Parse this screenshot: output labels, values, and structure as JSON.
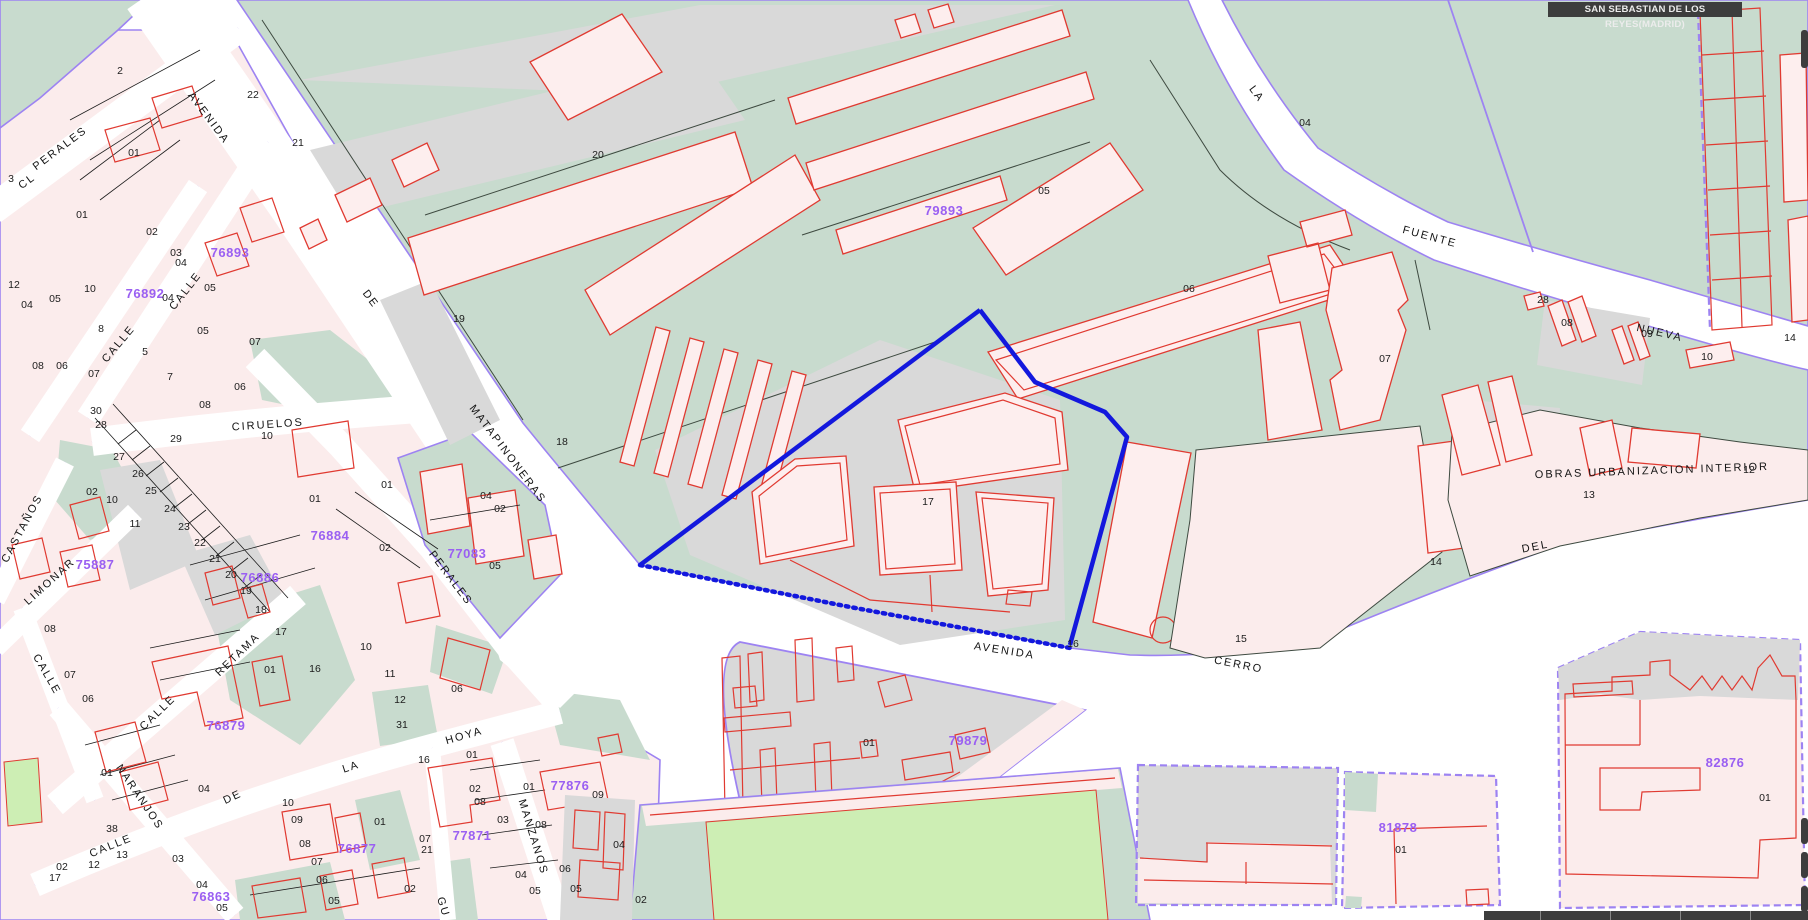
{
  "title_bar": {
    "text": "SAN SEBASTIAN DE LOS REYES(MADRID)"
  },
  "colors": {
    "block_teal": "#c8dbce",
    "road_gray": "#d9d9d9",
    "parcel_pink": "#fbecec",
    "building_red": "#e03a31",
    "boundary_purple": "#9d83f2",
    "highlight_blue": "#1318dd",
    "code_purple": "#9a5ff2",
    "field_green": "#cdeeb4",
    "titlebar_bg": "#3d3d3d",
    "street_white": "#ffffff"
  },
  "map": {
    "street_labels": [
      {
        "text": "AVENIDA",
        "x": 206,
        "y": 120,
        "rot": 53,
        "size": 12
      },
      {
        "text": "DE",
        "x": 368,
        "y": 301,
        "rot": 53
      },
      {
        "text": "MATAPINONERAS",
        "x": 505,
        "y": 456,
        "rot": 53
      },
      {
        "text": "CL",
        "x": 29,
        "y": 184,
        "rot": -37,
        "size": 10.5
      },
      {
        "text": "PERALES",
        "x": 62,
        "y": 151,
        "rot": -37,
        "size": 10.5
      },
      {
        "text": "CALLE",
        "x": 188,
        "y": 293,
        "rot": -52,
        "size": 10.5
      },
      {
        "text": "CALLE",
        "x": 121,
        "y": 346,
        "rot": -50,
        "size": 10.5
      },
      {
        "text": "CIRUELOS",
        "x": 268,
        "y": 428,
        "rot": -4,
        "size": 11.5
      },
      {
        "text": "CASTAÑOS",
        "x": 25,
        "y": 530,
        "rot": -62,
        "size": 10.5
      },
      {
        "text": "LIMONAR",
        "x": 52,
        "y": 584,
        "rot": -42,
        "size": 10.5
      },
      {
        "text": "CALLE",
        "x": 44,
        "y": 676,
        "rot": 60,
        "size": 10.5
      },
      {
        "text": "RETAMA",
        "x": 240,
        "y": 657,
        "rot": -44,
        "size": 10.5
      },
      {
        "text": "CALLE",
        "x": 160,
        "y": 715,
        "rot": -44,
        "size": 10.5
      },
      {
        "text": "NARANJOS",
        "x": 137,
        "y": 799,
        "rot": 56,
        "size": 10.5
      },
      {
        "text": "CALLE",
        "x": 112,
        "y": 849,
        "rot": -22,
        "size": 10.5
      },
      {
        "text": "DE",
        "x": 234,
        "y": 800,
        "rot": -25,
        "size": 10.5
      },
      {
        "text": "LA",
        "x": 352,
        "y": 770,
        "rot": -18,
        "size": 10.5
      },
      {
        "text": "HOYA",
        "x": 465,
        "y": 739,
        "rot": -16,
        "size": 10.5
      },
      {
        "text": "MANZANOS",
        "x": 530,
        "y": 838,
        "rot": 73,
        "size": 10.5
      },
      {
        "text": "PERALES",
        "x": 448,
        "y": 580,
        "rot": 53,
        "size": 10.5
      },
      {
        "text": "GU",
        "x": 440,
        "y": 908,
        "rot": 73,
        "size": 10.5
      },
      {
        "text": "AVENIDA",
        "x": 1004,
        "y": 654,
        "rot": 9
      },
      {
        "text": "CERRO",
        "x": 1238,
        "y": 668,
        "rot": 11
      },
      {
        "text": "DEL",
        "x": 1536,
        "y": 550,
        "rot": -11
      },
      {
        "text": "FUENTE",
        "x": 1429,
        "y": 240,
        "rot": 15
      },
      {
        "text": "NUEVA",
        "x": 1659,
        "y": 336,
        "rot": 13
      },
      {
        "text": "LA",
        "x": 1254,
        "y": 96,
        "rot": 53
      },
      {
        "text": "OBRAS URBANIZACION INTERIOR",
        "x": 1652,
        "y": 474,
        "rot": -2,
        "size": 9.5
      }
    ],
    "block_codes": [
      {
        "text": "76893",
        "x": 230,
        "y": 257
      },
      {
        "text": "76892",
        "x": 145,
        "y": 298
      },
      {
        "text": "76884",
        "x": 330,
        "y": 540
      },
      {
        "text": "75887",
        "x": 95,
        "y": 569
      },
      {
        "text": "76886",
        "x": 260,
        "y": 582
      },
      {
        "text": "77083",
        "x": 467,
        "y": 558
      },
      {
        "text": "76879",
        "x": 226,
        "y": 730
      },
      {
        "text": "77876",
        "x": 570,
        "y": 790
      },
      {
        "text": "77871",
        "x": 472,
        "y": 840
      },
      {
        "text": "76877",
        "x": 357,
        "y": 853
      },
      {
        "text": "76863",
        "x": 211,
        "y": 901
      },
      {
        "text": "79893",
        "x": 944,
        "y": 215
      },
      {
        "text": "79879",
        "x": 968,
        "y": 745
      },
      {
        "text": "82876",
        "x": 1725,
        "y": 767
      },
      {
        "text": "81878",
        "x": 1398,
        "y": 832
      }
    ],
    "parcel_numbers": [
      {
        "text": "2",
        "x": 120,
        "y": 74
      },
      {
        "text": "01",
        "x": 134,
        "y": 156
      },
      {
        "text": "22",
        "x": 253,
        "y": 98
      },
      {
        "text": "21",
        "x": 298,
        "y": 146
      },
      {
        "text": "20",
        "x": 598,
        "y": 158
      },
      {
        "text": "19",
        "x": 459,
        "y": 322
      },
      {
        "text": "18",
        "x": 562,
        "y": 445
      },
      {
        "text": "17",
        "x": 928,
        "y": 505
      },
      {
        "text": "3",
        "x": 11,
        "y": 182
      },
      {
        "text": "01",
        "x": 82,
        "y": 218
      },
      {
        "text": "02",
        "x": 152,
        "y": 235
      },
      {
        "text": "03",
        "x": 176,
        "y": 256
      },
      {
        "text": "04",
        "x": 181,
        "y": 266
      },
      {
        "text": "05",
        "x": 210,
        "y": 291
      },
      {
        "text": "12",
        "x": 14,
        "y": 288
      },
      {
        "text": "10",
        "x": 90,
        "y": 292
      },
      {
        "text": "05",
        "x": 55,
        "y": 302
      },
      {
        "text": "04",
        "x": 27,
        "y": 308
      },
      {
        "text": "04",
        "x": 168,
        "y": 301
      },
      {
        "text": "8",
        "x": 101,
        "y": 332
      },
      {
        "text": "5",
        "x": 145,
        "y": 355
      },
      {
        "text": "7",
        "x": 170,
        "y": 380
      },
      {
        "text": "08",
        "x": 38,
        "y": 369
      },
      {
        "text": "06",
        "x": 62,
        "y": 369
      },
      {
        "text": "07",
        "x": 94,
        "y": 377
      },
      {
        "text": "05",
        "x": 203,
        "y": 334
      },
      {
        "text": "07",
        "x": 255,
        "y": 345
      },
      {
        "text": "06",
        "x": 240,
        "y": 390
      },
      {
        "text": "08",
        "x": 205,
        "y": 408
      },
      {
        "text": "10",
        "x": 267,
        "y": 439
      },
      {
        "text": "30",
        "x": 96,
        "y": 414
      },
      {
        "text": "28",
        "x": 101,
        "y": 428
      },
      {
        "text": "29",
        "x": 176,
        "y": 442
      },
      {
        "text": "27",
        "x": 119,
        "y": 460
      },
      {
        "text": "26",
        "x": 138,
        "y": 477
      },
      {
        "text": "25",
        "x": 151,
        "y": 494
      },
      {
        "text": "24",
        "x": 170,
        "y": 512
      },
      {
        "text": "23",
        "x": 184,
        "y": 530
      },
      {
        "text": "22",
        "x": 200,
        "y": 546
      },
      {
        "text": "21",
        "x": 215,
        "y": 562
      },
      {
        "text": "20",
        "x": 231,
        "y": 578
      },
      {
        "text": "19",
        "x": 246,
        "y": 594
      },
      {
        "text": "18",
        "x": 261,
        "y": 613
      },
      {
        "text": "01",
        "x": 315,
        "y": 502
      },
      {
        "text": "02",
        "x": 92,
        "y": 495
      },
      {
        "text": "10",
        "x": 112,
        "y": 503
      },
      {
        "text": "11",
        "x": 135,
        "y": 527
      },
      {
        "text": "01",
        "x": 387,
        "y": 488
      },
      {
        "text": "04",
        "x": 486,
        "y": 499
      },
      {
        "text": "02",
        "x": 500,
        "y": 512
      },
      {
        "text": "05",
        "x": 495,
        "y": 569
      },
      {
        "text": "02",
        "x": 385,
        "y": 551
      },
      {
        "text": "08",
        "x": 50,
        "y": 632
      },
      {
        "text": "07",
        "x": 70,
        "y": 678
      },
      {
        "text": "06",
        "x": 88,
        "y": 702
      },
      {
        "text": "01",
        "x": 270,
        "y": 673
      },
      {
        "text": "17",
        "x": 281,
        "y": 635
      },
      {
        "text": "16",
        "x": 315,
        "y": 672
      },
      {
        "text": "10",
        "x": 366,
        "y": 650
      },
      {
        "text": "11",
        "x": 390,
        "y": 677
      },
      {
        "text": "12",
        "x": 400,
        "y": 703
      },
      {
        "text": "31",
        "x": 402,
        "y": 728
      },
      {
        "text": "01",
        "x": 107,
        "y": 776
      },
      {
        "text": "04",
        "x": 204,
        "y": 792
      },
      {
        "text": "38",
        "x": 112,
        "y": 832
      },
      {
        "text": "13",
        "x": 122,
        "y": 858
      },
      {
        "text": "12",
        "x": 94,
        "y": 868
      },
      {
        "text": "17",
        "x": 55,
        "y": 881
      },
      {
        "text": "02",
        "x": 62,
        "y": 870
      },
      {
        "text": "03",
        "x": 178,
        "y": 862
      },
      {
        "text": "04",
        "x": 202,
        "y": 888
      },
      {
        "text": "05",
        "x": 222,
        "y": 911
      },
      {
        "text": "16",
        "x": 424,
        "y": 763
      },
      {
        "text": "10",
        "x": 288,
        "y": 806
      },
      {
        "text": "09",
        "x": 297,
        "y": 823
      },
      {
        "text": "08",
        "x": 305,
        "y": 847
      },
      {
        "text": "07",
        "x": 317,
        "y": 865
      },
      {
        "text": "06",
        "x": 322,
        "y": 883
      },
      {
        "text": "05",
        "x": 334,
        "y": 904
      },
      {
        "text": "01",
        "x": 380,
        "y": 825
      },
      {
        "text": "07",
        "x": 425,
        "y": 842
      },
      {
        "text": "02",
        "x": 410,
        "y": 892
      },
      {
        "text": "06",
        "x": 457,
        "y": 692
      },
      {
        "text": "01",
        "x": 472,
        "y": 758
      },
      {
        "text": "02",
        "x": 475,
        "y": 792
      },
      {
        "text": "08",
        "x": 480,
        "y": 805
      },
      {
        "text": "03",
        "x": 503,
        "y": 823
      },
      {
        "text": "04",
        "x": 521,
        "y": 878
      },
      {
        "text": "05",
        "x": 535,
        "y": 894
      },
      {
        "text": "01",
        "x": 529,
        "y": 790
      },
      {
        "text": "09",
        "x": 598,
        "y": 798
      },
      {
        "text": "08",
        "x": 541,
        "y": 828
      },
      {
        "text": "04",
        "x": 619,
        "y": 848
      },
      {
        "text": "06",
        "x": 565,
        "y": 872
      },
      {
        "text": "05",
        "x": 576,
        "y": 892
      },
      {
        "text": "02",
        "x": 641,
        "y": 903
      },
      {
        "text": "21",
        "x": 427,
        "y": 853
      },
      {
        "text": "05",
        "x": 1044,
        "y": 194
      },
      {
        "text": "06",
        "x": 1189,
        "y": 292
      },
      {
        "text": "07",
        "x": 1385,
        "y": 362
      },
      {
        "text": "04",
        "x": 1305,
        "y": 126
      },
      {
        "text": "28",
        "x": 1543,
        "y": 303
      },
      {
        "text": "08",
        "x": 1567,
        "y": 326
      },
      {
        "text": "09",
        "x": 1647,
        "y": 337
      },
      {
        "text": "10",
        "x": 1707,
        "y": 360
      },
      {
        "text": "14",
        "x": 1790,
        "y": 341
      },
      {
        "text": "12",
        "x": 1749,
        "y": 473
      },
      {
        "text": "13",
        "x": 1589,
        "y": 498
      },
      {
        "text": "14",
        "x": 1436,
        "y": 565
      },
      {
        "text": "15",
        "x": 1241,
        "y": 642
      },
      {
        "text": "16",
        "x": 1073,
        "y": 647
      },
      {
        "text": "01",
        "x": 869,
        "y": 746
      },
      {
        "text": "01",
        "x": 1401,
        "y": 853
      },
      {
        "text": "01",
        "x": 1765,
        "y": 801
      }
    ],
    "selected_parcel": {
      "number": "17",
      "block_code": "79893"
    }
  }
}
